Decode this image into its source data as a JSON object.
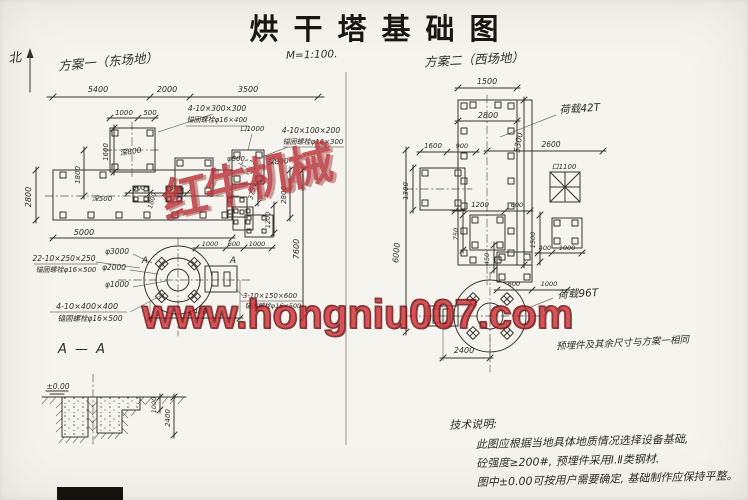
{
  "title": "烘干塔基础图",
  "scale": "M=1:100.",
  "north": "北",
  "plan1": {
    "name": "方案一（东场地）",
    "section_title": "A — A"
  },
  "plan2": {
    "name": "方案二（西场地）",
    "load_top": "荷载42T",
    "load_bottom": "荷载96T",
    "note": "预埋件及其余尺寸与方案一相同"
  },
  "tech_notes": {
    "heading": "技术说明:",
    "lines": [
      "此图应根据当地具体地质情况选择设备基础,",
      "砼强度≥200#, 预埋件采用Ⅰ.Ⅱ类钢材.",
      "图中±0.00可按用户需要确定, 基础制作应保持平整。"
    ]
  },
  "watermark": {
    "url": "www.hongniu007.com",
    "stamp": "红牛机械"
  },
  "colors": {
    "ink": "#38332d",
    "paper": "#f6f4ee",
    "watermark_red": "#d23238",
    "watermark_outline": "#6e1115",
    "stamp_red": "#b8343a"
  },
  "dim_labels": [
    [
      "5400",
      98,
      92,
      0,
      8
    ],
    [
      "2000",
      167,
      92,
      0,
      8
    ],
    [
      "3500",
      248,
      92,
      0,
      8
    ],
    [
      "1000",
      124,
      115,
      0,
      7
    ],
    [
      "500",
      150,
      115,
      0,
      7
    ],
    [
      "深800",
      131,
      154,
      -8,
      7.5
    ],
    [
      "4-10×300×300",
      217,
      111,
      0,
      7.5
    ],
    [
      "锚固螺栓φ16×400",
      217,
      122,
      0,
      7
    ],
    [
      "4-10×100×200",
      311,
      133,
      0,
      7.5
    ],
    [
      "锚固螺栓φ16×300",
      313,
      144,
      0,
      7
    ],
    [
      "口1000",
      252,
      131,
      0,
      7
    ],
    [
      "φ800",
      236,
      161,
      0,
      7
    ],
    [
      "深800",
      278,
      164,
      -5,
      7.5
    ],
    [
      "1600",
      108,
      152,
      -90,
      7
    ],
    [
      "1800",
      80,
      175,
      -90,
      7
    ],
    [
      "深500",
      102,
      201,
      0,
      7
    ],
    [
      "2800",
      31,
      197,
      -90,
      8
    ],
    [
      "5000",
      84,
      235,
      0,
      8
    ],
    [
      "500",
      139,
      190,
      0,
      6.5
    ],
    [
      "500",
      176,
      190,
      0,
      6.5
    ],
    [
      "1800",
      154,
      201,
      -75,
      6.5
    ],
    [
      "1000",
      210,
      246,
      0,
      6.5
    ],
    [
      "600",
      234,
      246,
      0,
      6.5
    ],
    [
      "1000",
      257,
      246,
      0,
      6.5
    ],
    [
      "375",
      254,
      194,
      -75,
      6.5
    ],
    [
      "1200",
      270,
      220,
      -90,
      6.5
    ],
    [
      "2800",
      286,
      195,
      -90,
      7
    ],
    [
      "7600",
      299,
      249,
      -90,
      8
    ],
    [
      "22-10×250×250",
      64,
      261,
      0,
      7.5
    ],
    [
      "锚固螺栓φ16×500",
      66,
      272,
      0,
      7
    ],
    [
      "φ3000",
      117,
      254,
      0,
      7.5
    ],
    [
      "φ2000",
      114,
      270,
      0,
      7.5
    ],
    [
      "φ1000",
      117,
      287,
      0,
      7.5
    ],
    [
      "4-10×400×400",
      87,
      309,
      0,
      8
    ],
    [
      "锚固螺栓φ16×500",
      90,
      321,
      0,
      7.5
    ],
    [
      "3-10×150×600",
      270,
      298,
      0,
      7
    ],
    [
      "锚固螺栓φ16×500",
      273,
      308,
      0,
      6.5
    ],
    [
      "2400",
      198,
      314,
      0,
      7.5
    ],
    [
      "A",
      145,
      263,
      0,
      9
    ],
    [
      "A",
      233,
      263,
      0,
      9
    ],
    [
      "±0.00",
      58,
      389,
      0,
      7.5
    ],
    [
      "1000",
      156,
      405,
      -90,
      6.5
    ],
    [
      "2400",
      170,
      418,
      -90,
      7
    ],
    [
      "1500",
      487,
      84,
      0,
      8
    ],
    [
      "2800",
      488,
      118,
      0,
      8
    ],
    [
      "5300",
      521,
      143,
      -80,
      8
    ],
    [
      "1600",
      433,
      148,
      0,
      7
    ],
    [
      "900",
      462,
      148,
      0,
      6.5
    ],
    [
      "2600",
      551,
      147,
      0,
      7.5
    ],
    [
      "口1100",
      564,
      169,
      0,
      7
    ],
    [
      "1300",
      408,
      191,
      -90,
      7
    ],
    [
      "6000",
      399,
      253,
      -85,
      8
    ],
    [
      "1200",
      480,
      207,
      0,
      7
    ],
    [
      "600",
      517,
      207,
      0,
      6.5
    ],
    [
      "750",
      458,
      234,
      -90,
      6.5
    ],
    [
      "450",
      489,
      259,
      -90,
      6.5
    ],
    [
      "600",
      514,
      286,
      0,
      6.5
    ],
    [
      "1000",
      549,
      286,
      0,
      6.5
    ],
    [
      "1500",
      535,
      240,
      -90,
      6.5
    ],
    [
      "1000",
      567,
      250,
      0,
      6.5
    ],
    [
      "400",
      545,
      250,
      0,
      6.5
    ],
    [
      "荷载42T",
      580,
      112,
      -4,
      10.5
    ],
    [
      "荷载96T",
      578,
      297,
      -3,
      10.5
    ],
    [
      "2400",
      464,
      353,
      0,
      8
    ]
  ]
}
